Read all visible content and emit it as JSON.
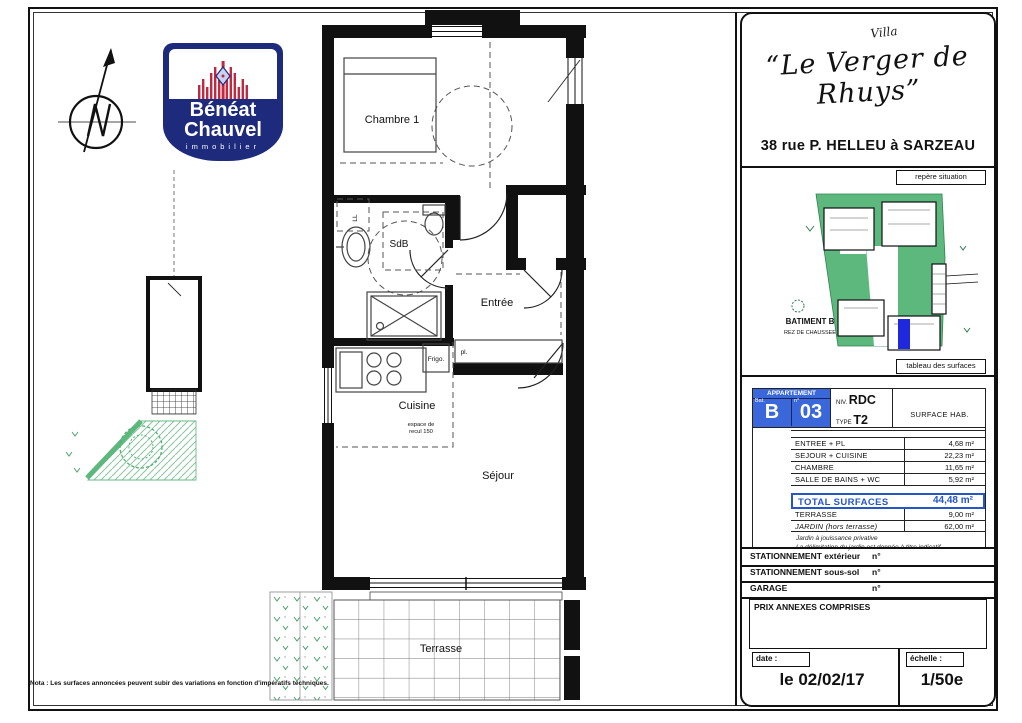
{
  "colors": {
    "navy": "#1e2b7d",
    "logo_red": "#c22840",
    "table_blue": "#3a67d9",
    "total_blue": "#2456c6",
    "site_green": "#5cb87d",
    "unit_blue": "#2028dd"
  },
  "logo": {
    "name1": "Bénéat",
    "name2": "Chauvel",
    "tagline": "immobilier"
  },
  "title_block": {
    "flourish": "Villa",
    "title": "“Le Verger de Rhuys”",
    "address": "38 rue P. HELLEU à SARZEAU",
    "repere_label": "repère situation",
    "site": {
      "batiment": "BATIMENT B",
      "niveau": "REZ DE CHAUSSEE"
    },
    "tableau_label": "tableau des surfaces"
  },
  "apartment": {
    "header": "APPARTEMENT",
    "bat_label": "Bat.",
    "bat_value": "B",
    "num_label": "n°",
    "num_value": "03",
    "niv_label": "NIV.",
    "niv_value": "RDC",
    "type_label": "TYPE",
    "type_value": "T2",
    "surface_col": "SURFACE HAB."
  },
  "surfaces": {
    "rows": [
      {
        "label": "ENTREE + PL",
        "value": "4,68 m²"
      },
      {
        "label": "SEJOUR + CUISINE",
        "value": "22,23 m²"
      },
      {
        "label": "CHAMBRE",
        "value": "11,65 m²"
      },
      {
        "label": "SALLE DE BAINS + WC",
        "value": "5,92 m²"
      }
    ],
    "total_label": "TOTAL SURFACES",
    "total_value": "44,48 m²",
    "extra": [
      {
        "label": "TERRASSE",
        "value": "9,00 m²"
      },
      {
        "label": "JARDIN (hors terrasse)",
        "value": "62,00 m²"
      }
    ],
    "note1": "Jardin à jouissance privative",
    "note2": "La délimitation du jardin est donnée à titre indicatif"
  },
  "parking": {
    "rows": [
      {
        "label": "STATIONNEMENT extérieur",
        "num": "n°"
      },
      {
        "label": "STATIONNEMENT sous-sol",
        "num": "n°"
      },
      {
        "label": "GARAGE",
        "num": "n°"
      }
    ],
    "prix": "PRIX ANNEXES COMPRISES"
  },
  "footer": {
    "date_label": "date :",
    "date_value": "le 02/02/17",
    "scale_label": "échelle :",
    "scale_value": "1/50e"
  },
  "plan": {
    "labels": {
      "chambre": "Chambre 1",
      "sdb": "SdB",
      "entree": "Entrée",
      "cuisine": "Cuisine",
      "sejour": "Séjour",
      "terrasse": "Terrasse",
      "frigo": "Frigo.",
      "placard": "pl.",
      "lavelinge": "LL",
      "recul1": "espace de",
      "recul2": "recul 150"
    }
  },
  "footnote": "Nota : Les surfaces annoncées peuvent subir des variations en fonction d'impératifs techniques."
}
